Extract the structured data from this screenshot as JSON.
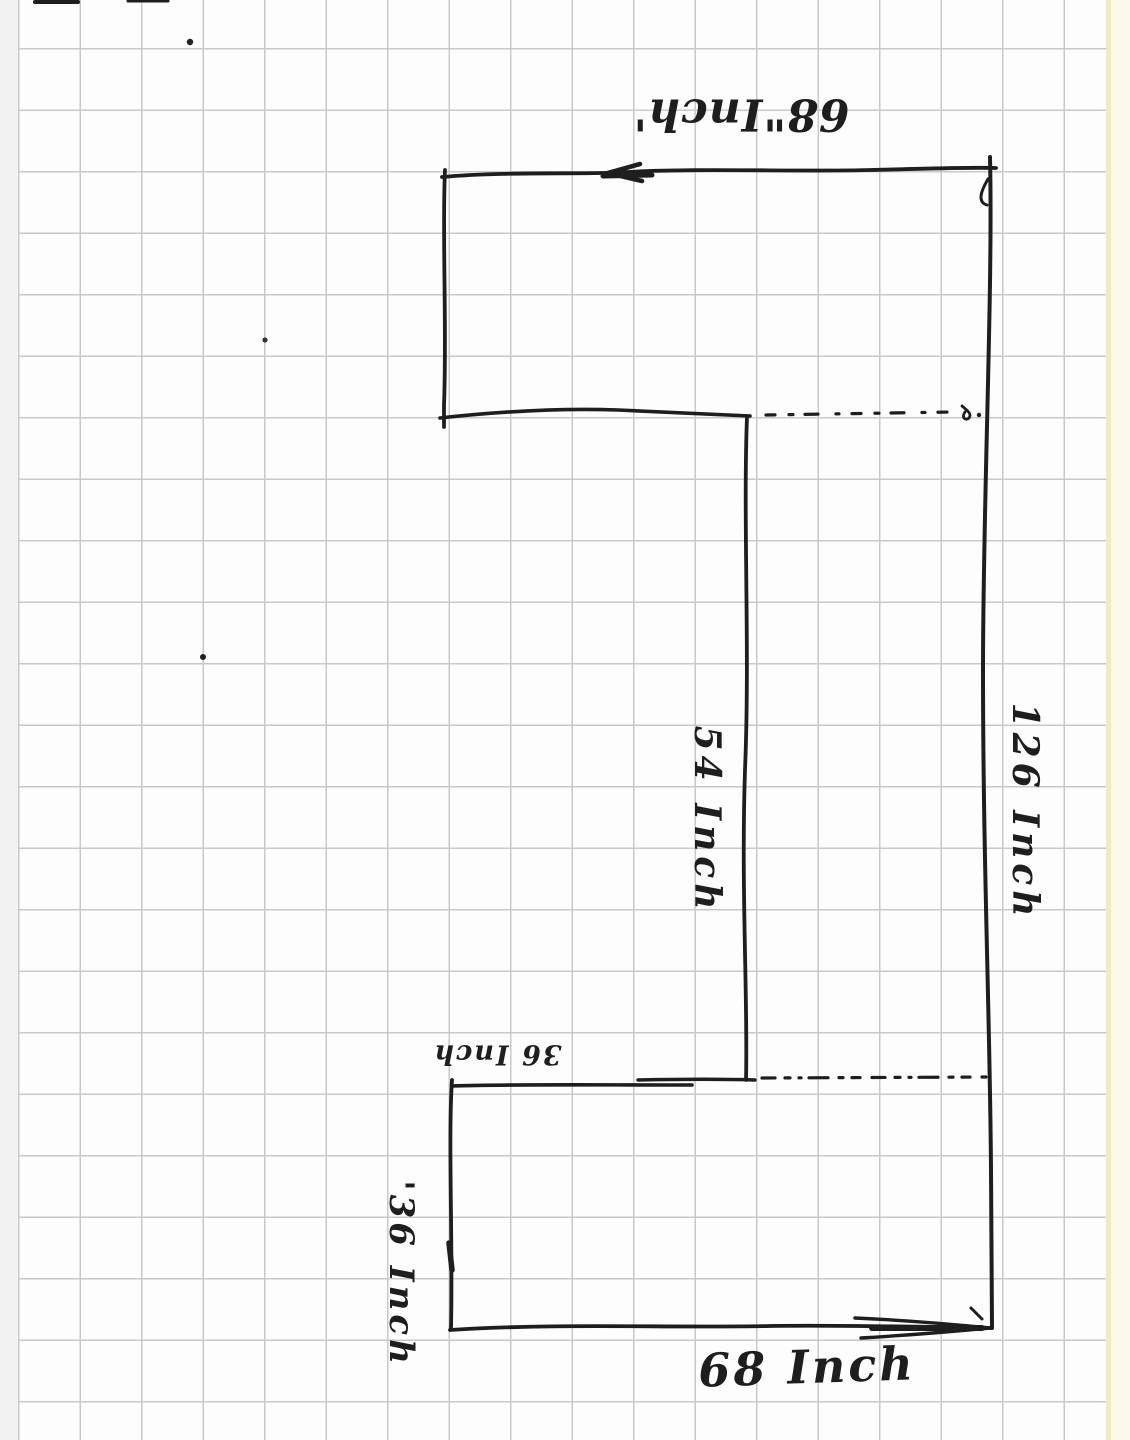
{
  "meta": {
    "description": "Hand-drawn dimensioned outline sketch on graph paper",
    "unit": "Inch"
  },
  "colors": {
    "ink": "#1e1e1e",
    "grid": "#c7c9cb",
    "paper": "#fdfdfd",
    "left-margin": "#f2f2f2",
    "right-margin": "#fcf9ea",
    "margin-strip": "#f2ebc2"
  },
  "figure": {
    "type": "dimensioned-outline-sketch",
    "shape": "Two offset rectangles joined into an S-shaped outline; upper rectangle open at lower-right (dashed edge), lower rectangle open at upper-right (dashed edge)",
    "dimensions": [
      {
        "edge": "upper-top",
        "value": 68,
        "unit": "Inch"
      },
      {
        "edge": "right-side-full",
        "value": 126,
        "unit": "Inch"
      },
      {
        "edge": "middle-vertical",
        "value": 54,
        "unit": "Inch"
      },
      {
        "edge": "lower-rect-top",
        "value": 36,
        "unit": "Inch"
      },
      {
        "edge": "lower-rect-left",
        "value": 36,
        "unit": "Inch"
      },
      {
        "edge": "lower-bottom",
        "value": 68,
        "unit": "Inch"
      }
    ]
  },
  "labels": {
    "top_width": {
      "text": "68\"Inch'",
      "value": 68,
      "unit": "Inch",
      "rotation_deg": 180
    },
    "right_height": {
      "text": "126 Inch",
      "value": 126,
      "unit": "Inch",
      "rotation_deg": 90
    },
    "middle_height": {
      "text": "54 Inch",
      "value": 54,
      "unit": "Inch",
      "rotation_deg": 90
    },
    "lower_top_width": {
      "text": "36 Inch",
      "value": 36,
      "unit": "Inch",
      "rotation_deg": 180
    },
    "lower_left_height": {
      "text": "'36 Inch",
      "value": 36,
      "unit": "Inch",
      "rotation_deg": 90
    },
    "bottom_width": {
      "text": "68 Inch",
      "value": 68,
      "unit": "Inch",
      "rotation_deg": 0
    }
  }
}
